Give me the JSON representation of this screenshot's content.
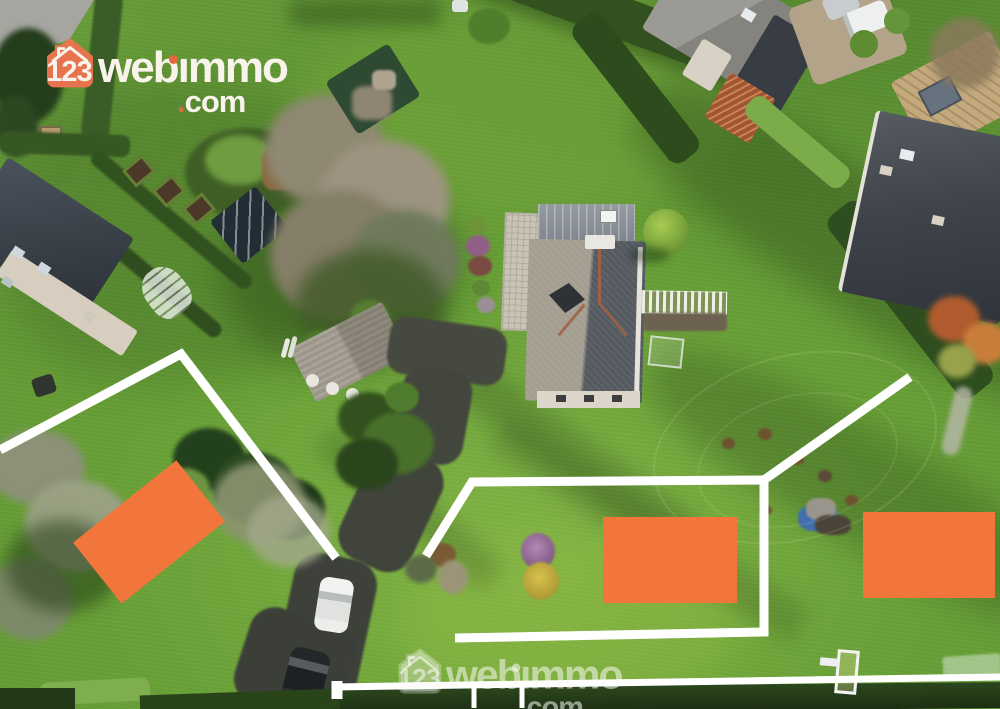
{
  "brand": {
    "house_number": "123",
    "name": "webimmo",
    "name_pre": "web",
    "i_glyph": "ı",
    "name_post": "mmo",
    "tld_dot": ".",
    "tld_text": "com",
    "icon_orange": "#E8744F",
    "accent_orange": "#E3683C",
    "text_cream": "#F8F4EB"
  },
  "watermark": {
    "opacity": 0.55
  },
  "annotations": {
    "plot_color": "#F2763B",
    "line_color": "#FFFFFF",
    "plots": [
      {
        "id": "plot-west",
        "cx": 149,
        "cy": 532,
        "w": 132,
        "h": 78,
        "rotation": -38.5
      },
      {
        "id": "plot-center",
        "cx": 670,
        "cy": 560,
        "w": 134,
        "h": 86,
        "rotation": 0
      },
      {
        "id": "plot-east",
        "cx": 929,
        "cy": 555,
        "w": 132,
        "h": 86,
        "rotation": 0
      }
    ],
    "boundaries": [
      {
        "id": "boundary-west-parcel",
        "points": [
          [
            0,
            450
          ],
          [
            181,
            354
          ],
          [
            336,
            558
          ]
        ],
        "width": 9
      },
      {
        "id": "boundary-center-parcel",
        "points": [
          [
            426,
            556
          ],
          [
            472,
            482
          ],
          [
            764,
            480
          ],
          [
            764,
            632
          ],
          [
            455,
            638
          ]
        ],
        "width": 9
      },
      {
        "id": "boundary-center-spur",
        "points": [
          [
            764,
            480
          ],
          [
            910,
            377
          ]
        ],
        "width": 9
      },
      {
        "id": "road-rail",
        "points": [
          [
            335,
            687
          ],
          [
            1000,
            677
          ]
        ],
        "width": 7
      },
      {
        "id": "road-rail-knob",
        "points": [
          [
            337,
            681
          ],
          [
            337,
            699
          ]
        ],
        "width": 11
      },
      {
        "id": "road-post-1",
        "points": [
          [
            474,
            688
          ],
          [
            474,
            708
          ]
        ],
        "width": 5
      },
      {
        "id": "road-post-2",
        "points": [
          [
            522,
            686
          ],
          [
            522,
            708
          ]
        ],
        "width": 5
      }
    ]
  }
}
